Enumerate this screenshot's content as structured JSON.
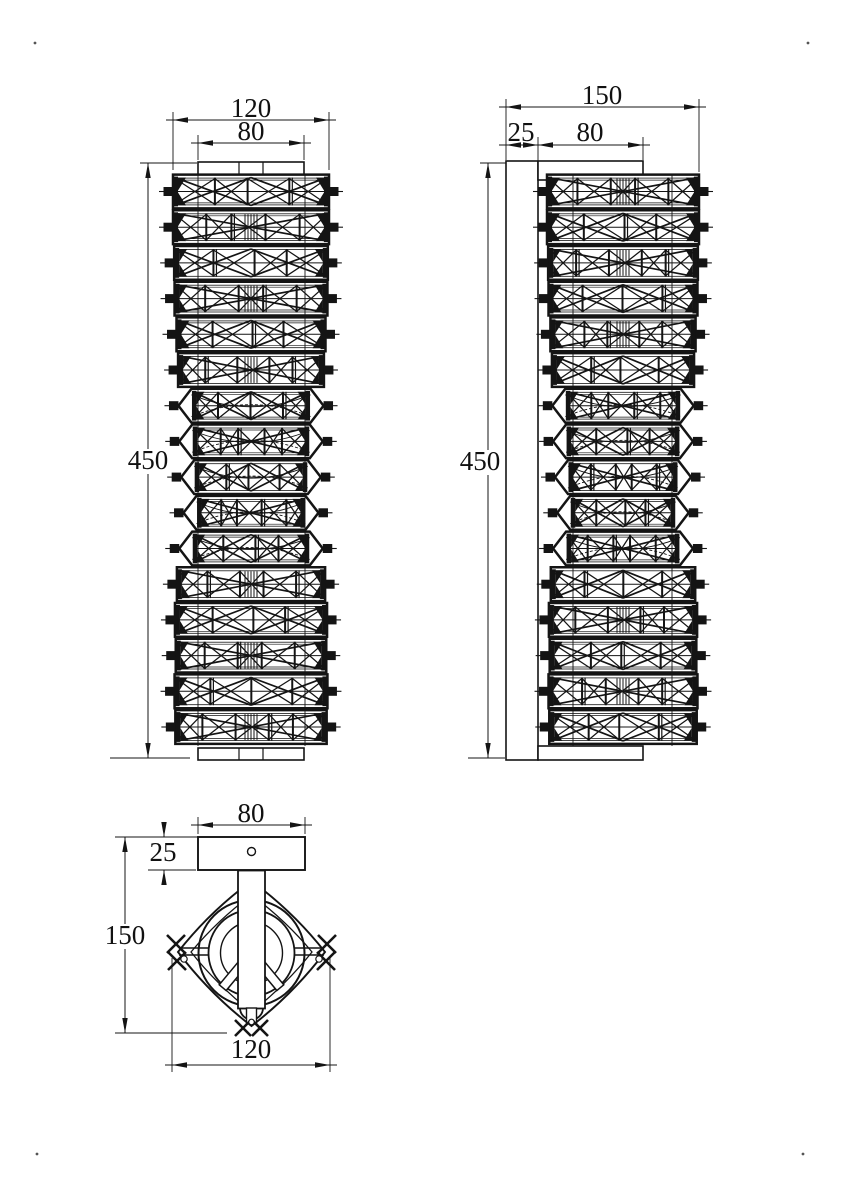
{
  "page": {
    "background": "#ffffff",
    "line_color": "#141414",
    "description": "technical-dimension-drawing-wall-lamp"
  },
  "views": {
    "front": {
      "crystal_rows": 16,
      "dims": {
        "overall_width": "120",
        "plate_width": "80",
        "overall_height": "450"
      }
    },
    "side": {
      "crystal_rows": 16,
      "dims": {
        "overall_depth": "150",
        "backplate_thickness": "25",
        "bracket_depth": "80",
        "overall_height": "450"
      }
    },
    "bottom": {
      "dims": {
        "plate_width": "80",
        "plate_thickness": "25",
        "overall_depth": "150",
        "overall_width": "120"
      }
    }
  }
}
